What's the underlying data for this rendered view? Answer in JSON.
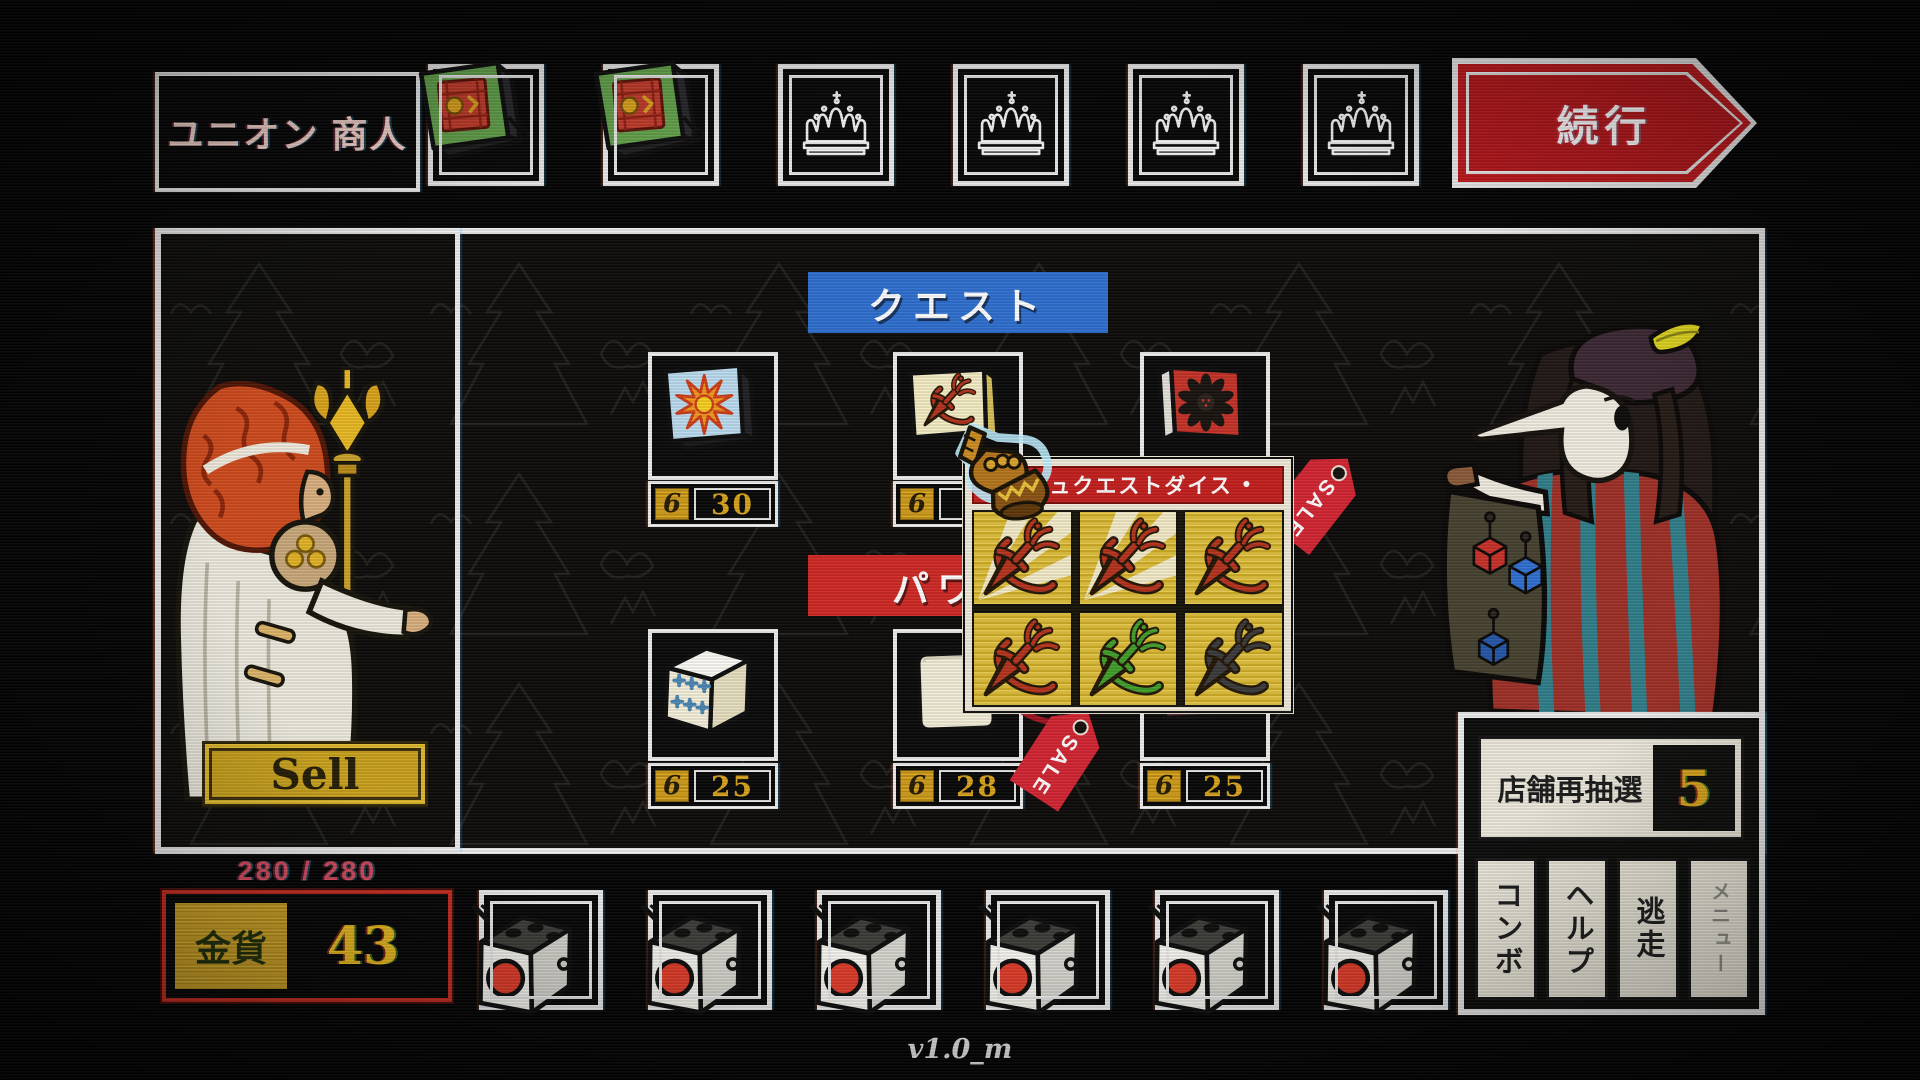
{
  "header": {
    "title": "ユニオン 商人",
    "continue_label": "続行",
    "top_slots": [
      "green-die",
      "green-die",
      "crown",
      "crown",
      "crown",
      "crown"
    ]
  },
  "shop": {
    "currency_symbol": "6",
    "quest_banner": "クエスト",
    "power_banner": "パワ",
    "sale_label": "SALE",
    "quest_items": [
      {
        "icon": "sunburst-die",
        "price": "30",
        "sale": false
      },
      {
        "icon": "red-dagger-die",
        "price": "",
        "sale": false
      },
      {
        "icon": "black-flower-die",
        "price": "",
        "sale": true
      }
    ],
    "power_items": [
      {
        "icon": "blue-pips-die",
        "price": "25",
        "sale": false
      },
      {
        "icon": "blank-die",
        "price": "28",
        "sale": true
      },
      {
        "icon": "mace-die",
        "price": "25",
        "sale": false
      }
    ]
  },
  "tooltip": {
    "bullet_left": "•",
    "title": "ーシュクエストダイス",
    "bullet_right": "•",
    "faces": [
      {
        "icon": "dagger",
        "hex": "#b5321c",
        "rays": true
      },
      {
        "icon": "dagger",
        "hex": "#b5321c",
        "rays": true
      },
      {
        "icon": "dagger",
        "hex": "#b5321c",
        "rays": false
      },
      {
        "icon": "dagger",
        "hex": "#b5321c",
        "rays": false
      },
      {
        "icon": "dagger",
        "hex": "#3f9e2a",
        "rays": false
      },
      {
        "icon": "dagger",
        "hex": "#3a3a3a",
        "rays": false
      }
    ]
  },
  "left_panel": {
    "sell_label": "Sell",
    "hp": "280 / 280",
    "gold_label": "金貨",
    "gold_value": "43"
  },
  "right_panel": {
    "reroll_label": "店舗再抽選",
    "reroll_count": "5",
    "buttons": [
      {
        "label": "コンボ",
        "disabled": false
      },
      {
        "label": "ヘルプ",
        "disabled": false
      },
      {
        "label": "逃走",
        "disabled": false
      },
      {
        "label": "メニュー",
        "disabled": true
      }
    ]
  },
  "inventory": {
    "slots": [
      "red-dot-die",
      "red-dot-die",
      "red-dot-die",
      "red-dot-die",
      "red-dot-die",
      "red-dot-die"
    ]
  },
  "footer": {
    "version": "v1.0_m"
  },
  "colors": {
    "quest_banner_blue": "#2e6fd0",
    "power_banner_red": "#cf2824",
    "sale_red": "#d22431",
    "gold": "#d8a21a",
    "continue_red": "#c0181c"
  }
}
